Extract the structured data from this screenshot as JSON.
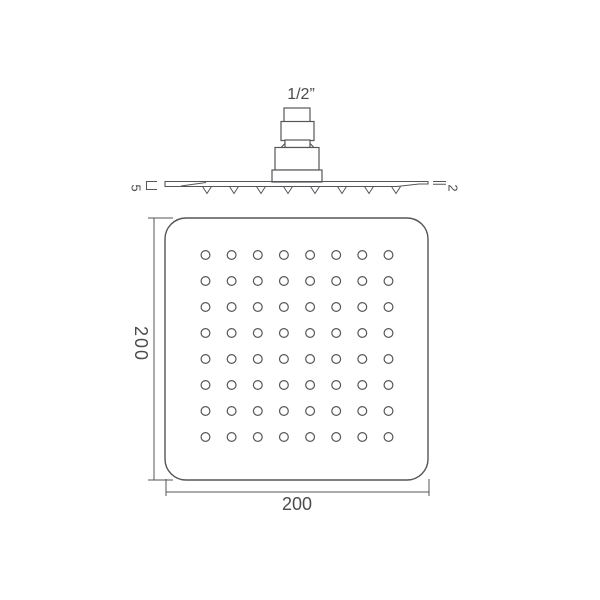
{
  "drawing": {
    "background": "#ffffff",
    "line_color": "#56565a",
    "text_color": "#4b4b4d",
    "side_view": {
      "connector_label": "1/2”",
      "thickness_label": "5",
      "edge_label": "2",
      "teeth_count": 8
    },
    "face_view": {
      "height_label": "200",
      "width_label": "200",
      "hole_rows": 8,
      "hole_cols": 8
    }
  }
}
